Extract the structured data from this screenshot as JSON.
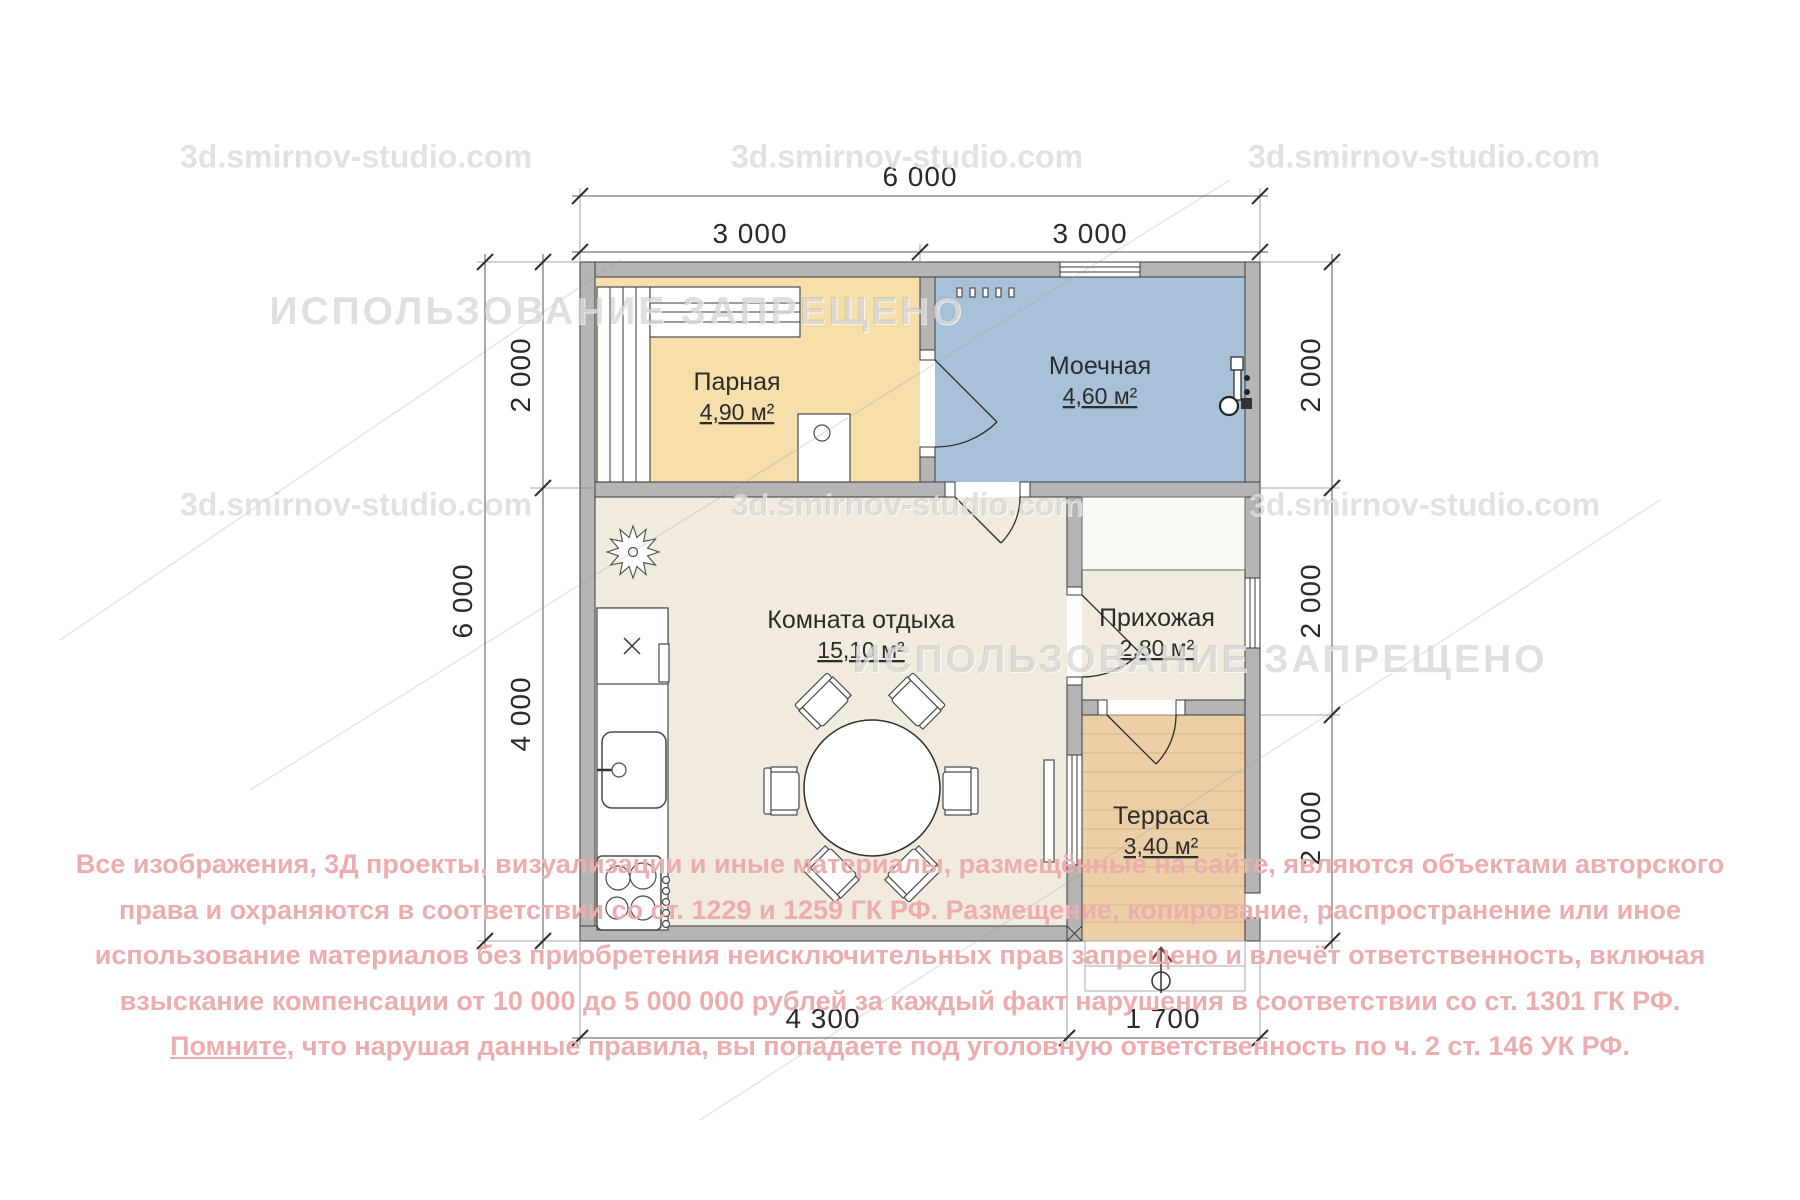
{
  "watermarks": {
    "site": "3d.smirnov-studio.com",
    "forbidden": "ИСПОЛЬЗОВАНИЕ ЗАПРЕЩЕНО"
  },
  "rooms": {
    "parnaya": {
      "name": "Парная",
      "area": "4,90 м²"
    },
    "moechnaya": {
      "name": "Моечная",
      "area": "4,60 м²"
    },
    "lounge": {
      "name": "Комната отдыха",
      "area": "15,10 м²"
    },
    "hallway": {
      "name": "Прихожая",
      "area": "2,80 м²"
    },
    "terrace": {
      "name": "Терраса",
      "area": "3,40 м²"
    }
  },
  "dimensions": {
    "top_total": "6 000",
    "top_left": "3 000",
    "top_right": "3 000",
    "left_total": "6 000",
    "left_top": "2 000",
    "left_bottom": "4 000",
    "right_top": "2 000",
    "right_middle": "2 000",
    "right_bottom": "2 000",
    "bottom_left": "4 300",
    "bottom_right": "1 700"
  },
  "copyright": {
    "line1": "Все изображения, 3Д проекты, визуализации и иные материалы, размещённые на сайте, являются объектами авторского",
    "line2": "права и охраняются в соответствии со ст. 1229 и 1259 ГК РФ. Размещение, копирование, распространение или иное",
    "line3": "использование материалов без приобретения неисключительных прав запрещено и влечёт ответственность, включая",
    "line4": "взыскание компенсации от 10 000 до 5 000 000 рублей за каждый факт нарушения в соответствии со ст. 1301 ГК РФ.",
    "line5_underlined": "Помните,",
    "line5_rest": " что нарушая данные правила, вы попадаете под уголовную ответственность по ч. 2 ст. 146 УК РФ."
  },
  "colors": {
    "wall_fill": "#b5b5b5",
    "parnaya_fill": "#f7dfab",
    "moechnaya_fill": "#a7c2d8",
    "lounge_fill": "#f1ebdf",
    "terrace_fill": "#eccfa6",
    "copyright_pink": "#ebadad"
  }
}
